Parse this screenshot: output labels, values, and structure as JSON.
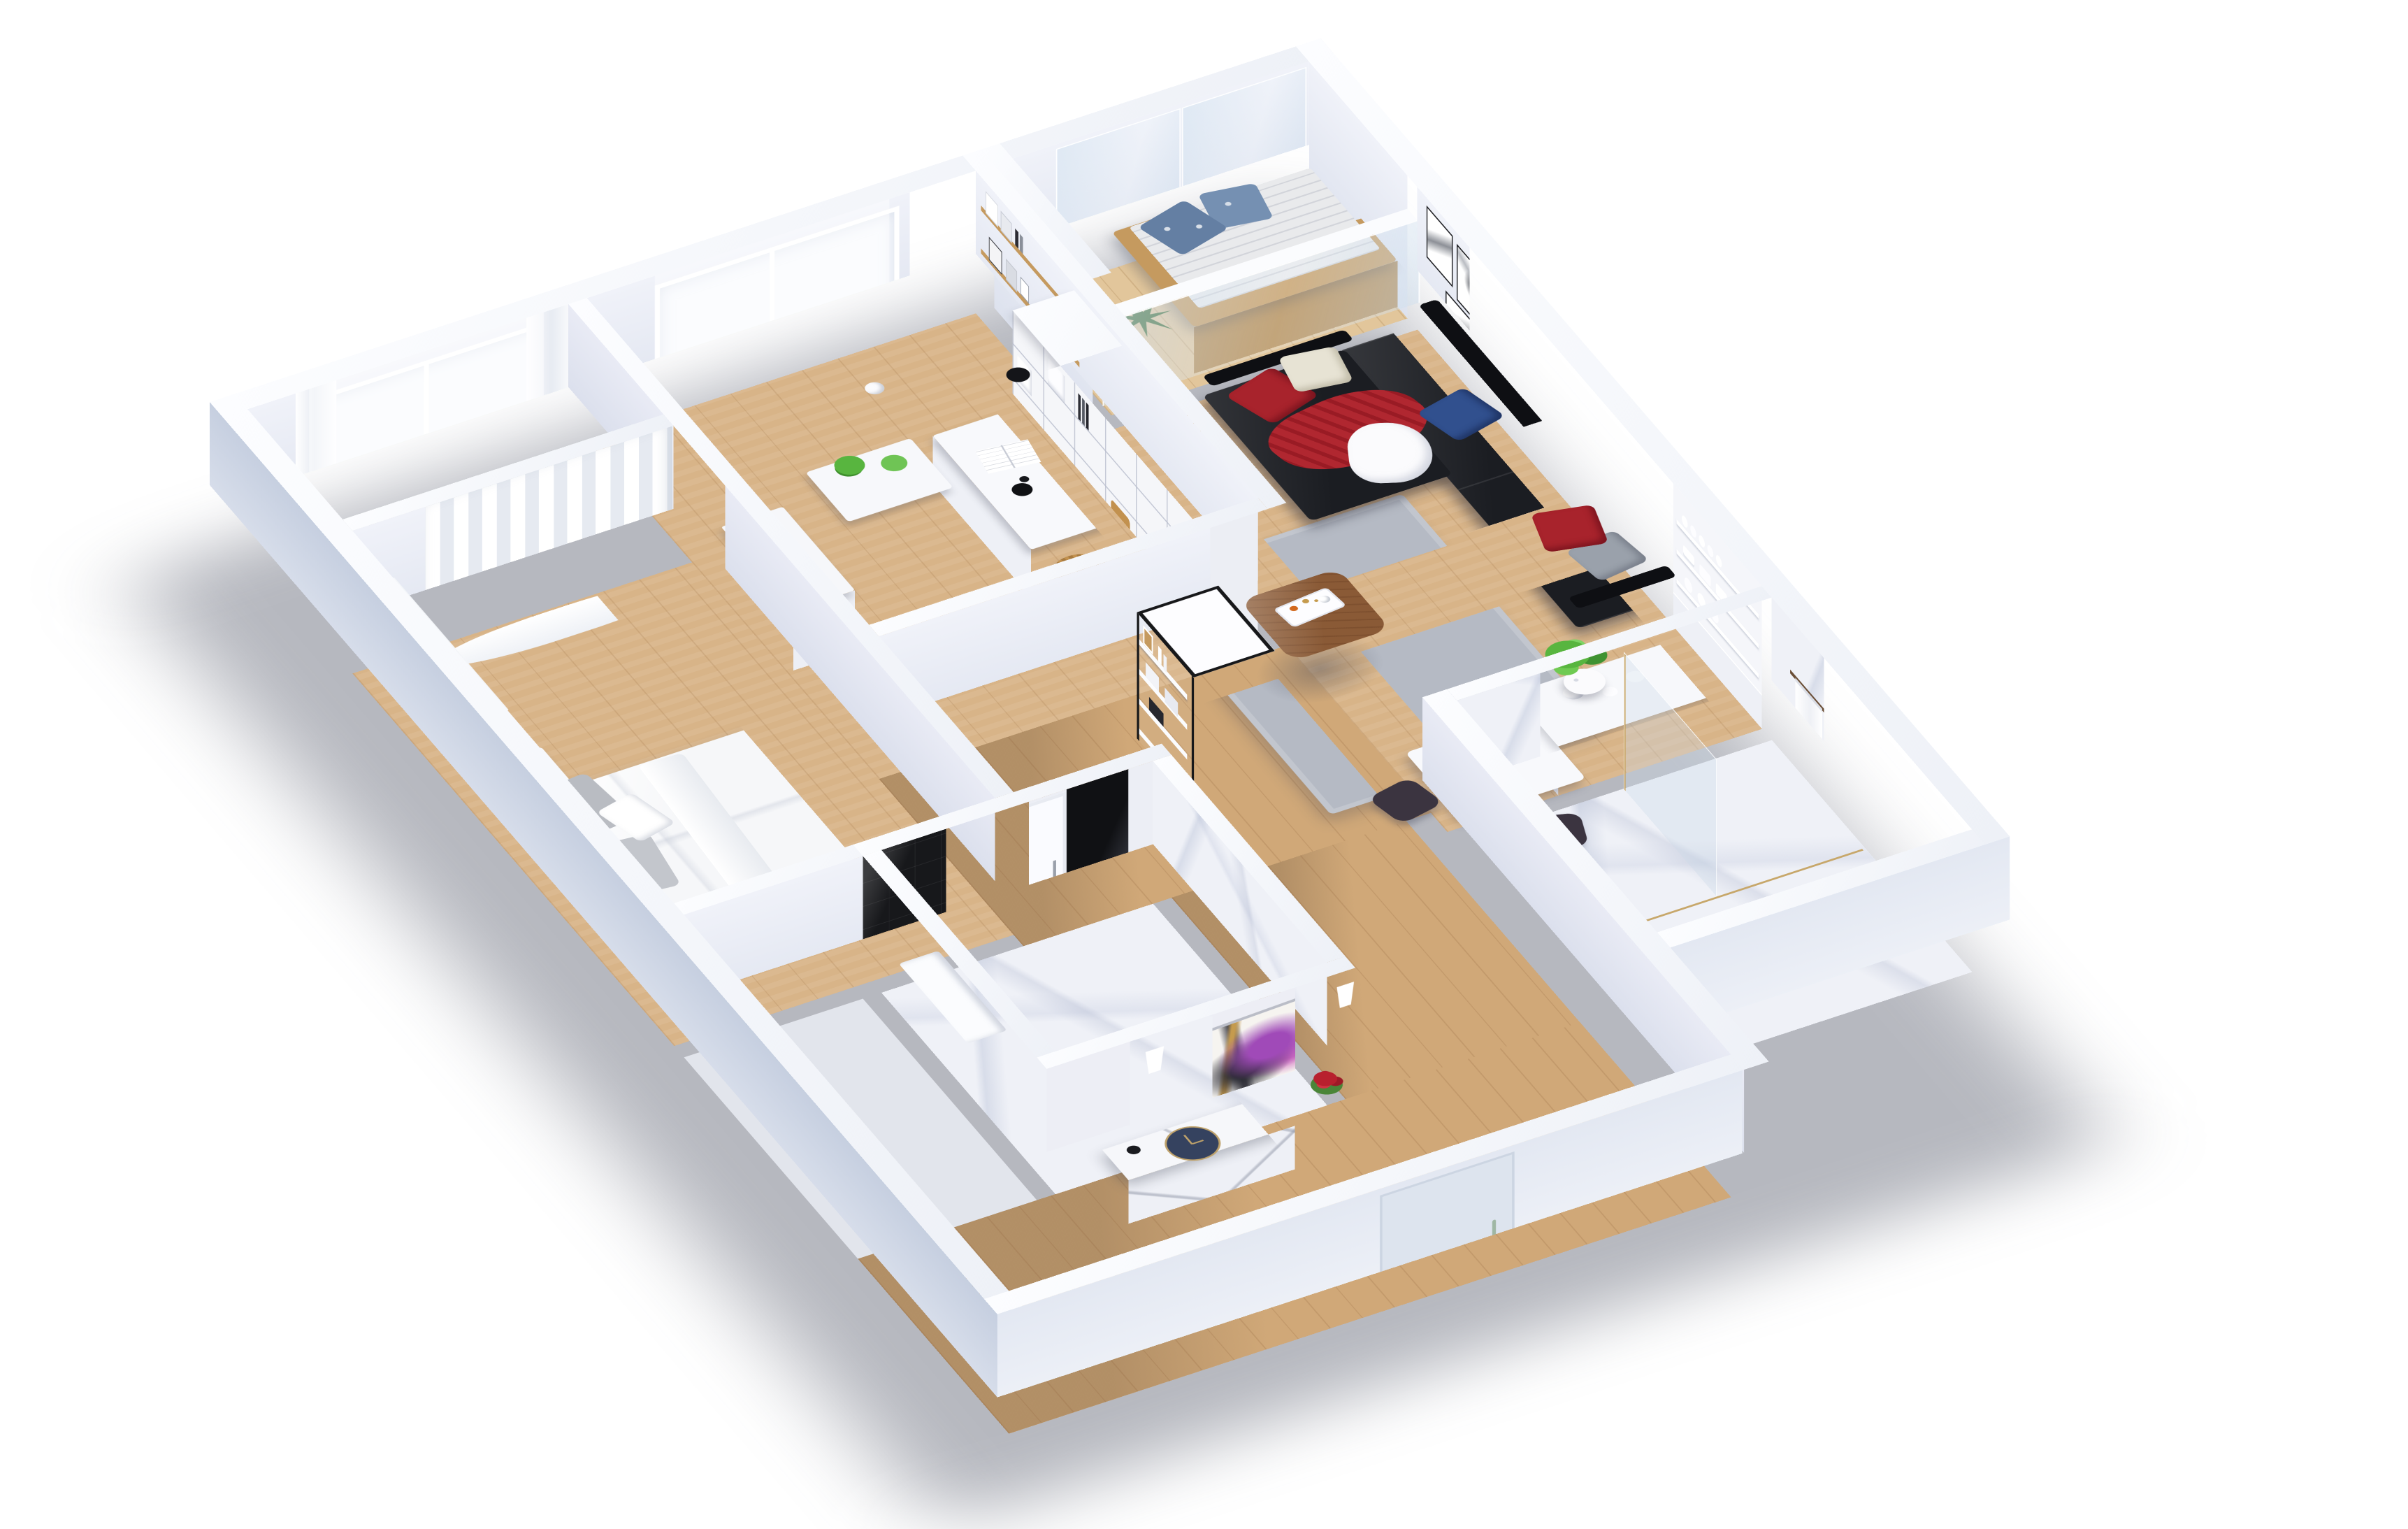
{
  "meta": {
    "view": "3d-isometric-floor-plan-render",
    "description": "3D floor plan of a furnished apartment viewed from above, white cut walls on a white background",
    "visible_text": ""
  },
  "palette": {
    "background": "#ffffff",
    "wall_top": "#f8fafc",
    "wall_interior": "#e8eaf3",
    "wall_exterior_shaded": "#c6cfe0",
    "wall_exterior_light": "#e3e8f2",
    "floor_wood": "#d8b488",
    "floor_wood_hall": "#d0a878",
    "floor_balcony": "#e2c69b",
    "floor_marble": "#eff1f7",
    "floor_tile": "#e2e5ec",
    "rug": "#b5bac4",
    "sofa": "#1b1d22",
    "pillow_red": "#a8232c",
    "pillow_blue": "#31508e",
    "pillow_beige": "#e7e3d4",
    "pillow_gray": "#9aa1ab",
    "throw_red": "#b02730",
    "coffee_table_wood": "#8a5a36",
    "dining_chair": "#3b3440",
    "bench_wood": "#c59a5f",
    "mattress": "#e9eaec",
    "balcony_pillow_blue": "#647fa3",
    "plant_green": "#58b53f",
    "snake_plant_green": "#3e6b33",
    "wicker": "#c2914f",
    "black_tile": "#17181b",
    "clock_navy": "#35425f",
    "clock_gold": "#bfa26b",
    "art_purple": "#a04ab8",
    "art_gold": "#c59b4e",
    "flower_red": "#b8202e",
    "flower_magenta": "#c2519f",
    "door_handle": "#9fb7a4",
    "towel_bar": "#6a4e36",
    "frame_black": "#1d1e22",
    "bed_duvet": "#f6f7f9"
  },
  "rooms": [
    {
      "name": "bedroom",
      "floor": "wood",
      "furniture": [
        "double-bed-white-duvet",
        "gray-pillows",
        "white-nightstand",
        "red-roses-pot",
        "leaning-mirror",
        "window-with-curtains",
        "floor-length-sheer-curtain",
        "radiator"
      ]
    },
    {
      "name": "study-bedroom-2",
      "floor": "wood",
      "furniture": [
        "white-desk",
        "open-book",
        "black-desk-lamp",
        "white-cubby-bookcase",
        "wood-wall-shelves-with-prints",
        "two-wicker-baskets",
        "white-dresser",
        "plant-side-table",
        "potted-plants",
        "black-pendant-lamp",
        "white-sphere-pendant",
        "window-radiator"
      ]
    },
    {
      "name": "balcony",
      "floor": "wood-decking",
      "furniture": [
        "wooden-daybed",
        "striped-mattress",
        "blue-pattern-pillows",
        "snake-plant",
        "glass-railing",
        "glass-partition"
      ]
    },
    {
      "name": "living-room",
      "floor": "wood",
      "furniture": [
        "black-leather-sectional-sofa",
        "red-pillows",
        "blue-pillow",
        "beige-pillow",
        "gray-pillow",
        "red-throw-blanket",
        "white-cloth",
        "gallery-wall-seven-framed-prints",
        "walnut-coffee-table",
        "decor-tray",
        "gray-area-rug",
        "tall-white-vase-plant",
        "black-metal-etagere"
      ]
    },
    {
      "name": "dining-kitchen",
      "floor": "wood",
      "furniture": [
        "white-dining-table",
        "dark-chairs",
        "magenta-flower-centerpiece",
        "white-kitchen-counter",
        "open-dish-shelves",
        "white-plates",
        "white-cups"
      ]
    },
    {
      "name": "bathroom",
      "floor": "marble",
      "furniture": [
        "carrara-marble-walls",
        "towel-bars",
        "white-towels",
        "roller-blind-window",
        "glass-shower-panel"
      ]
    },
    {
      "name": "wc-shower-room",
      "floor": "marble",
      "furniture": [
        "black-mosaic-tile-wall",
        "white-door",
        "black-glass-panel",
        "white-trough-sink"
      ]
    },
    {
      "name": "hallway-entry",
      "floor": "wood",
      "furniture": [
        "white-sideboard-diagonal-seams",
        "abstract-purple-artwork",
        "navy-round-clock",
        "two-white-sconces",
        "red-gladiolus-vase",
        "entry-door-with-handle"
      ]
    }
  ],
  "counts": {
    "gallery_frames": 7,
    "towels": 2,
    "wicker_baskets": 2,
    "balcony_pillows": 2,
    "dining_chairs": 2,
    "sconces": 2
  }
}
